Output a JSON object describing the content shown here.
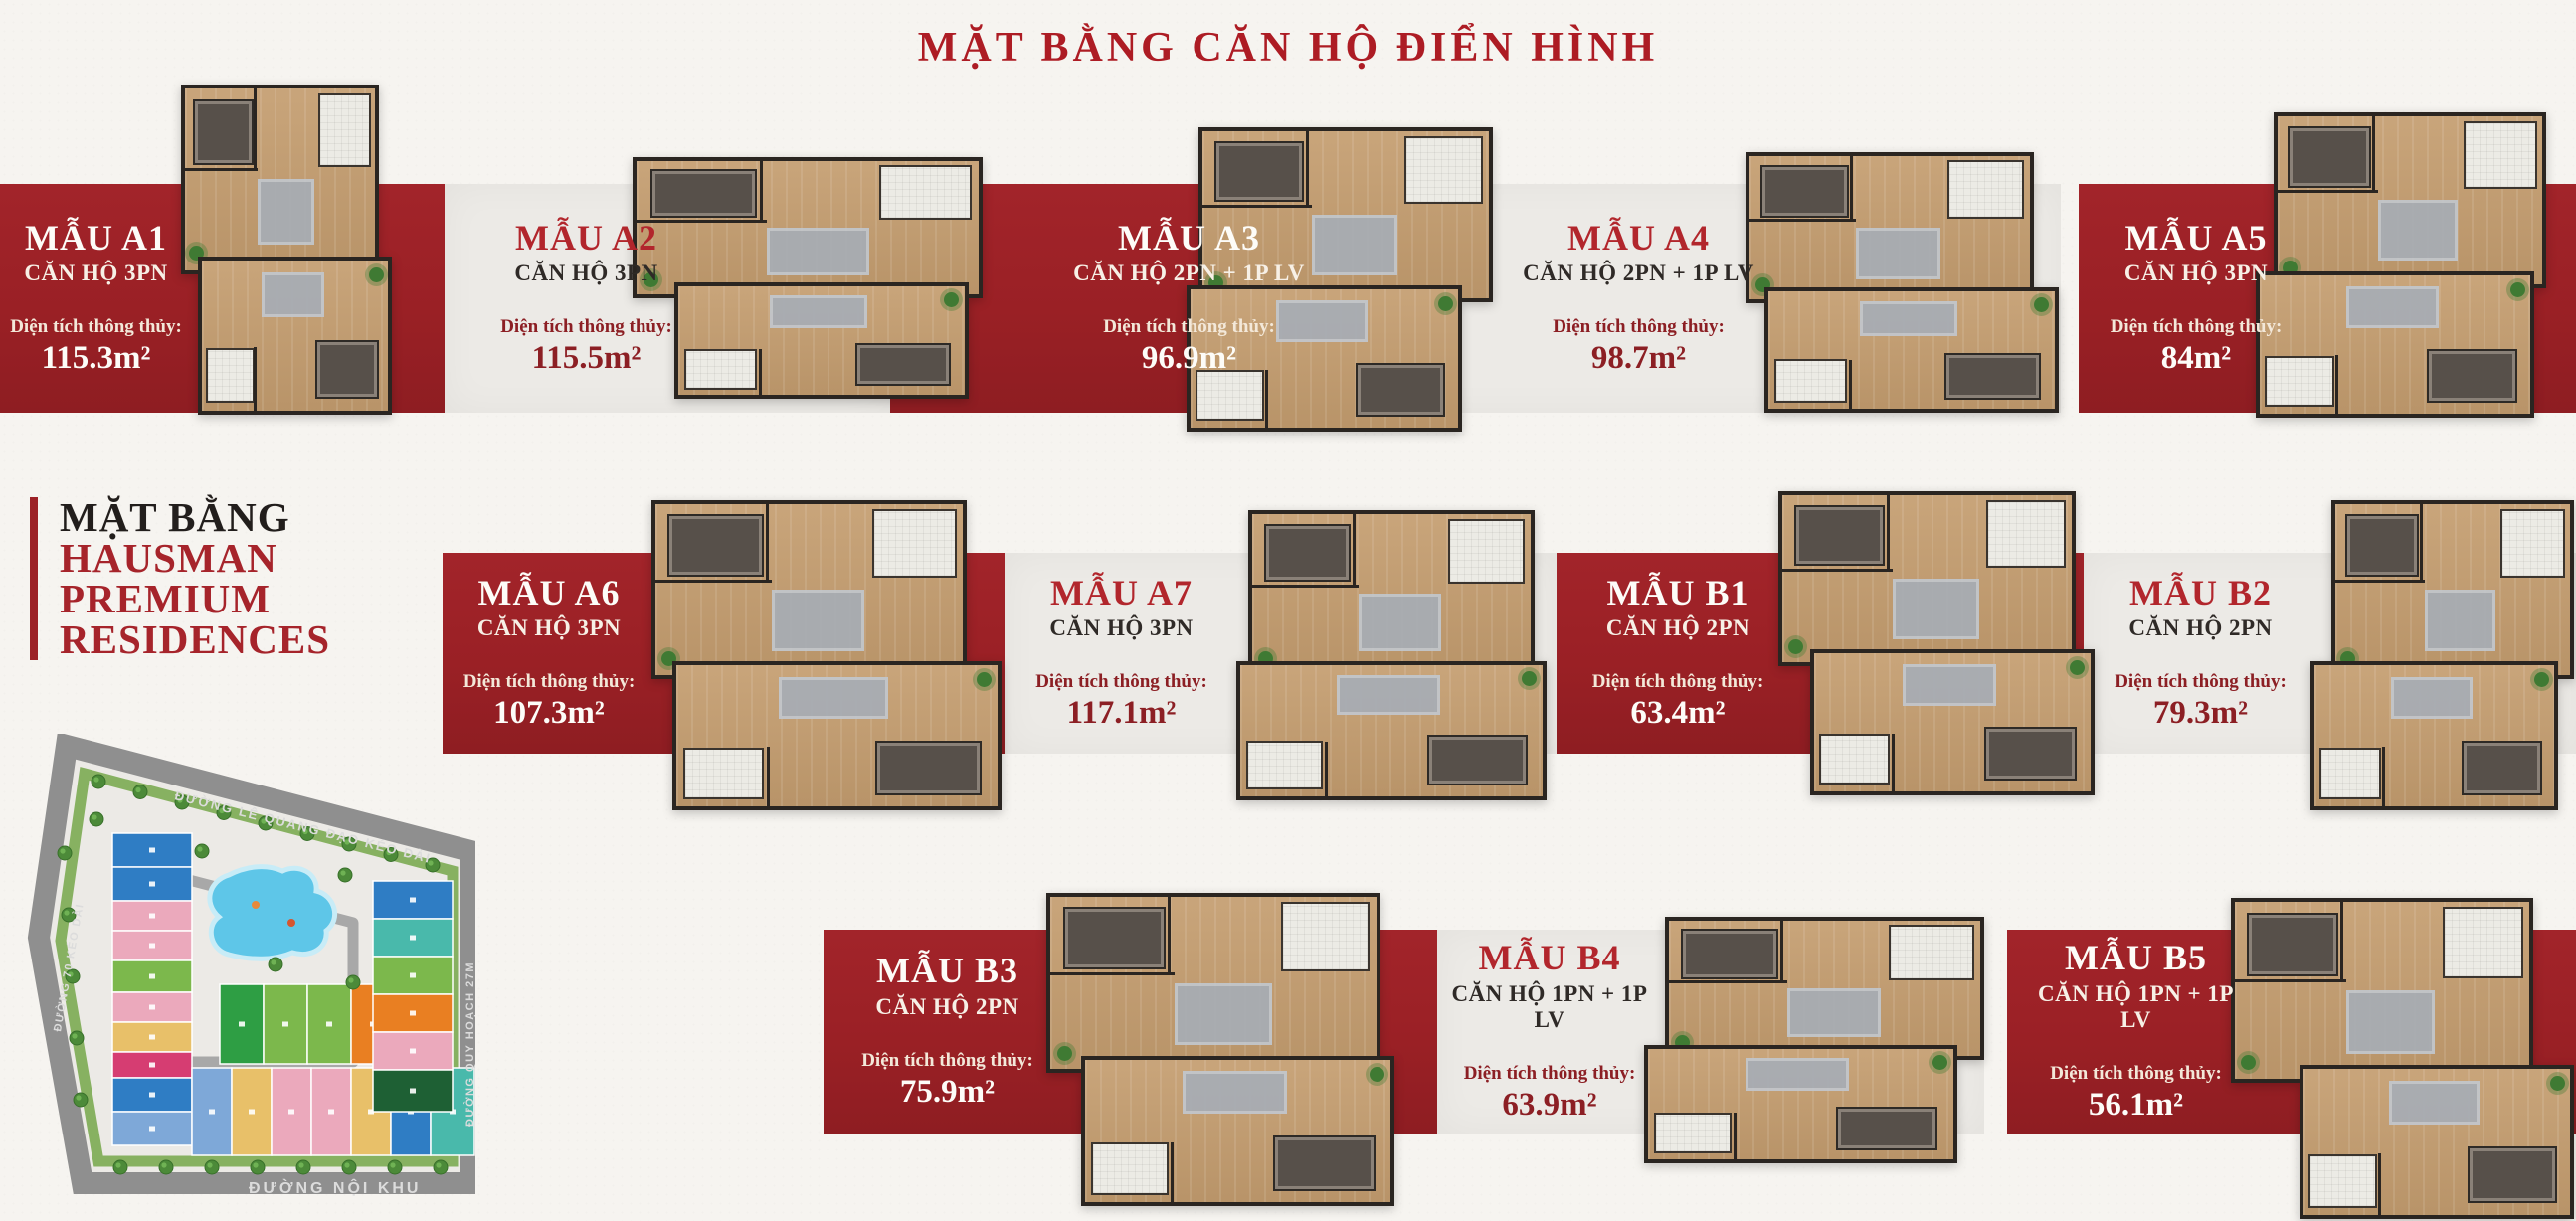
{
  "title": "MẶT BẰNG CĂN HỘ ĐIỂN HÌNH",
  "project": {
    "line1": "MẶT BẰNG",
    "line2": "HAUSMAN",
    "line3": "PREMIUM",
    "line4": "RESIDENCES"
  },
  "area_label": "Diện tích thông thủy:",
  "units": [
    {
      "id": "A1",
      "name": "MẪU A1",
      "type": "CĂN HỘ 3PN",
      "area": "115.3m²",
      "panel": "red"
    },
    {
      "id": "A2",
      "name": "MẪU A2",
      "type": "CĂN HỘ 3PN",
      "area": "115.5m²",
      "panel": "gray"
    },
    {
      "id": "A3",
      "name": "MẪU A3",
      "type": "CĂN HỘ 2PN + 1P LV",
      "area": "96.9m²",
      "panel": "red"
    },
    {
      "id": "A4",
      "name": "MẪU A4",
      "type": "CĂN HỘ 2PN + 1P LV",
      "area": "98.7m²",
      "panel": "gray"
    },
    {
      "id": "A5",
      "name": "MẪU A5",
      "type": "CĂN HỘ 3PN",
      "area": "84m²",
      "panel": "red"
    },
    {
      "id": "A6",
      "name": "MẪU A6",
      "type": "CĂN HỘ 3PN",
      "area": "107.3m²",
      "panel": "red"
    },
    {
      "id": "A7",
      "name": "MẪU A7",
      "type": "CĂN HỘ 3PN",
      "area": "117.1m²",
      "panel": "gray"
    },
    {
      "id": "B1",
      "name": "MẪU B1",
      "type": "CĂN HỘ 2PN",
      "area": "63.4m²",
      "panel": "red"
    },
    {
      "id": "B2",
      "name": "MẪU B2",
      "type": "CĂN HỘ 2PN",
      "area": "79.3m²",
      "panel": "gray"
    },
    {
      "id": "B3",
      "name": "MẪU B3",
      "type": "CĂN HỘ 2PN",
      "area": "75.9m²",
      "panel": "red"
    },
    {
      "id": "B4",
      "name": "MẪU B4",
      "type": "CĂN HỘ 1PN + 1P LV",
      "area": "63.9m²",
      "panel": "gray"
    },
    {
      "id": "B5",
      "name": "MẪU B5",
      "type": "CĂN HỘ 1PN + 1P LV",
      "area": "56.1m²",
      "panel": "red"
    }
  ],
  "map": {
    "road_top": "ĐƯỜNG LÊ QUANG ĐẠO KÉO DÀI",
    "road_left": "ĐƯỜNG 70 KÉO DÀI",
    "road_bottom": "ĐƯỜNG NỘI KHU",
    "road_right": "ĐƯỜNG QUY HOẠCH 27M"
  },
  "colors": {
    "brand_red": "#9c2126",
    "accent_red": "#b2262c",
    "maroon": "#8c1f24",
    "panel_gray": "#eceae6",
    "pool_blue": "#5ec6e8",
    "grass_green": "#7cab52",
    "road_gray": "#8f8f8f"
  }
}
